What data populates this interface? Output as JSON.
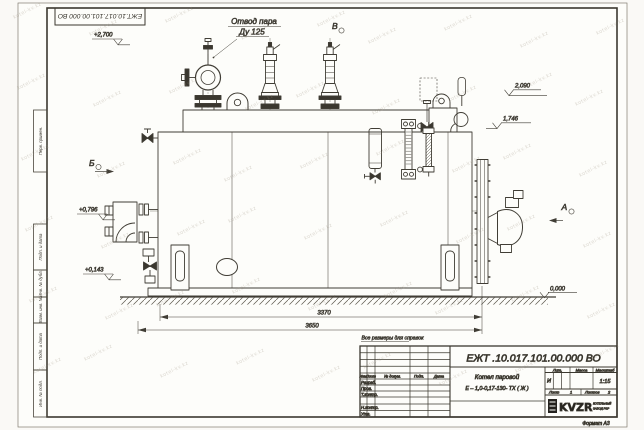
{
  "watermark": "kotel-kv.kz",
  "sheet": {
    "corner_doc_number": "ЕЖТ.10.017.101.00.000  ВО",
    "format_label": "Формат А3",
    "margin_labels": {
      "perv_primen": "Перв. примен.",
      "podp_data_1": "Подп. и дата",
      "inv_dubl": "Инв. № дубл.",
      "vzam_inv": "Взам. инв. №",
      "podp_data_2": "Подп. и дата",
      "inv_podl": "Инв. № подл."
    }
  },
  "drawing": {
    "callout_line1": "Отвод пара",
    "callout_line2": "Ду 125",
    "reference_note": "Все размеры для справок",
    "view_a": "А",
    "view_b": "Б",
    "view_v": "В",
    "elev_2700": "+2,700",
    "elev_2090": "2,090",
    "elev_1746": "1,746",
    "elev_0796": "+0,796",
    "elev_0143": "+0,143",
    "elev_0000": "0,000",
    "dim_3370": "3370",
    "dim_3650": "3650"
  },
  "title_block": {
    "doc_number": "ЕЖТ .10.017.101.00.000  ВО",
    "product_line1": "Котел паровой",
    "product_line2": "Е – 1,0-0,17-130- ТХ ( Ж )",
    "col_izm": "Изм.",
    "col_list": "Лист",
    "col_doc": "№ докум.",
    "col_podp": "Подп.",
    "col_data": "Дата",
    "row_razrab": "Разраб.",
    "row_prov": "Пров.",
    "row_tkontr": "Т.контр.",
    "row_nkontr": "Н.контр.",
    "row_utv": "Утв.",
    "lit_label": "Лит.",
    "mass_label": "Масса",
    "scale_label": "Масштаб",
    "lit_value": "И",
    "scale_value": "1:15",
    "sheet_label": "Лист",
    "sheet_value": "1",
    "sheets_label": "Листов",
    "sheets_value": "2",
    "company_name": "KVZR",
    "company_sub1": "КОТЕЛЬНЫЙ",
    "company_sub2": "ЗАВОД РЗР"
  }
}
